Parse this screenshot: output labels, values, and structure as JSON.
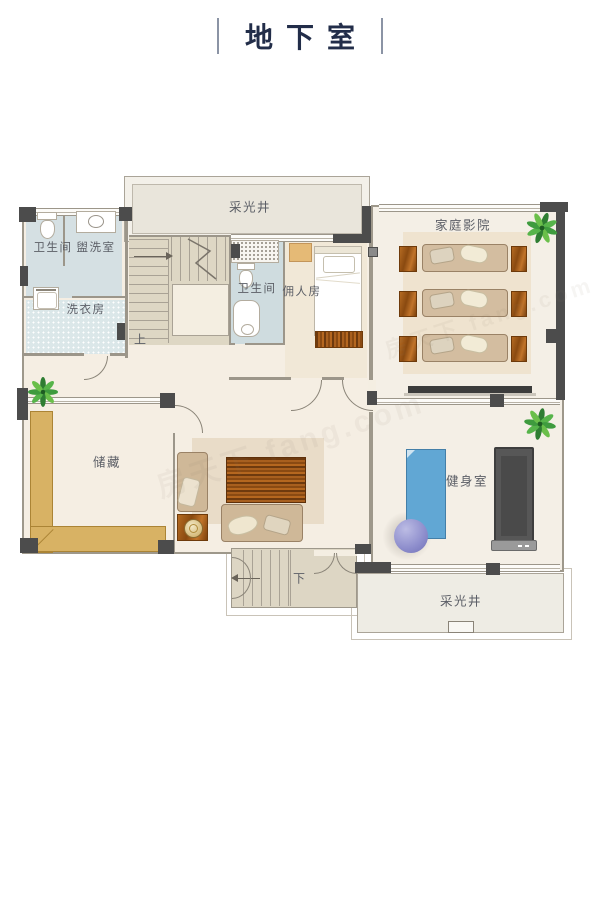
{
  "title": "地下室",
  "watermark": "房天下 fang.com",
  "rooms": {
    "skylight_top": "采光井",
    "bathroom_upper_left": "卫生间",
    "washroom": "盥洗室",
    "laundry": "洗衣房",
    "bathroom_middle": "卫生间",
    "maid_room": "佣人房",
    "home_theater": "家庭影院",
    "storage": "储藏",
    "gym": "健身室",
    "skylight_bottom": "采光井"
  },
  "stairs": {
    "up": "上",
    "down": "下"
  },
  "colors": {
    "wall_column": "#4c4c4c",
    "floor_cream": "#f5eee3",
    "bathroom_floor": "#d2dee1",
    "stair_fill": "#ded7c4",
    "living_rug": "#e9dcc8",
    "theater_rug": "#efe3cf",
    "shelf_wood": "#d8b264",
    "furniture_wood": "#a85f1e",
    "sofa_tan": "#cfb898",
    "gym_mat_blue": "#61a7d4",
    "gym_ball_purple": "#8d8dcc",
    "treadmill_gray": "#575757",
    "plant_green": "#3e9b3e",
    "title_color": "#222d49",
    "label_color": "#5b5e66"
  }
}
